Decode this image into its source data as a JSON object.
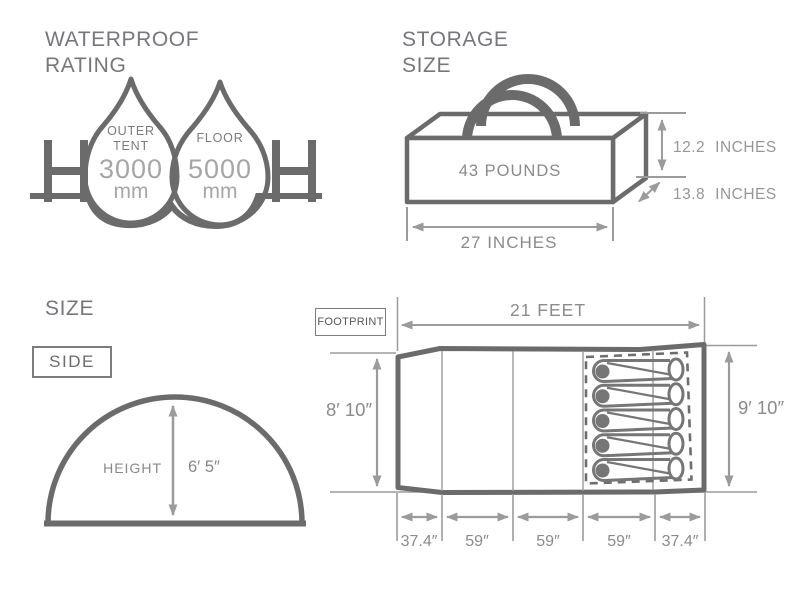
{
  "waterproof": {
    "title_line1": "WATERPROOF",
    "title_line2": "RATING",
    "outer_tent": {
      "label_line1": "OUTER",
      "label_line2": "TENT",
      "value": "3000",
      "unit": "mm"
    },
    "floor": {
      "label": "FLOOR",
      "value": "5000",
      "unit": "mm"
    }
  },
  "storage": {
    "title_line1": "STORAGE",
    "title_line2": "SIZE",
    "weight": "43 POUNDS",
    "height_value": "12.2",
    "height_unit": "INCHES",
    "depth_value": "13.8",
    "depth_unit": "INCHES",
    "width_value": "27 INCHES"
  },
  "size": {
    "title": "SIZE",
    "view_label": "SIDE",
    "height_label": "HEIGHT",
    "height_value": "6′ 5″"
  },
  "footprint": {
    "view_label": "FOOTPRINT",
    "length": "21 FEET",
    "left_height": "8′ 10″",
    "right_height": "9′ 10″",
    "segments": [
      "37.4″",
      "59″",
      "59″",
      "59″",
      "37.4″"
    ]
  },
  "colors": {
    "outline": "#6b6b6b",
    "dimension_line": "#9b9b9b",
    "heading_text": "#76777a",
    "dimension_text": "#8b8b8b",
    "light_value_text": "#a6a6a6"
  }
}
